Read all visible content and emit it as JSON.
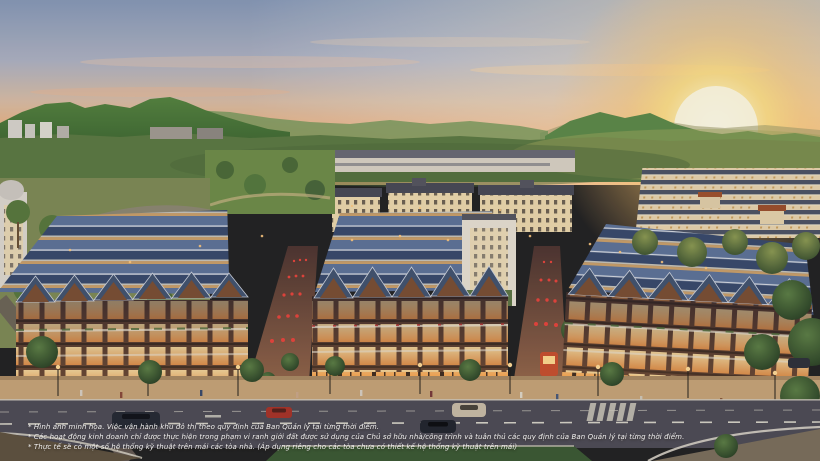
{
  "image": {
    "type": "real-estate-aerial-render",
    "description": "Sunset aerial rendering of a low-rise shophouse / townhouse urban development: three blocks of 4-storey shophouses with slate-blue herringbone roofs and warmly lit facades, pedestrian streets strung with red lanterns, tree-lined boulevard with cars in the foreground, cream French-colonial style buildings and rows of townhouses in the midground, green mountains and a glowing sun on the horizon."
  },
  "colors": {
    "sky_top": "#8799b6",
    "sky_mid": "#d9bda4",
    "sky_horizon": "#f8a763",
    "sun_glow": "#fffdf0",
    "mountain_green": "#55843f",
    "treeline": "#5c7a42",
    "roof_slate_light": "#5e7398",
    "roof_slate_dark": "#394a6c",
    "facade_wood": "#5e4131",
    "window_glow": "#ffcf7e",
    "cream_wall": "#ecd8ad",
    "road": "#4e4c55",
    "road_marking": "#d5d2c6",
    "grass_median": "#3c5a33",
    "lantern_red": "#e8453c",
    "disclaimer_text": "#ffffff"
  },
  "disclaimer": {
    "lines": [
      "* Hình ảnh minh họa. Việc vận hành khu đô thị theo quy định của Ban Quản lý tại từng thời điểm.",
      "* Các hoạt động kinh doanh chỉ được thực hiện trong phạm vi ranh giới đất được sử dụng của Chủ sở hữu nhà/công trình và tuân thủ các quy định của Ban Quản lý tại từng thời điểm.",
      "* Thực tế sẽ có một số hệ thống kỹ thuật trên mái các tòa nhà. (Áp dụng riêng cho các tòa chưa có thiết kế hệ thống kỹ thuật trên mái)"
    ]
  }
}
